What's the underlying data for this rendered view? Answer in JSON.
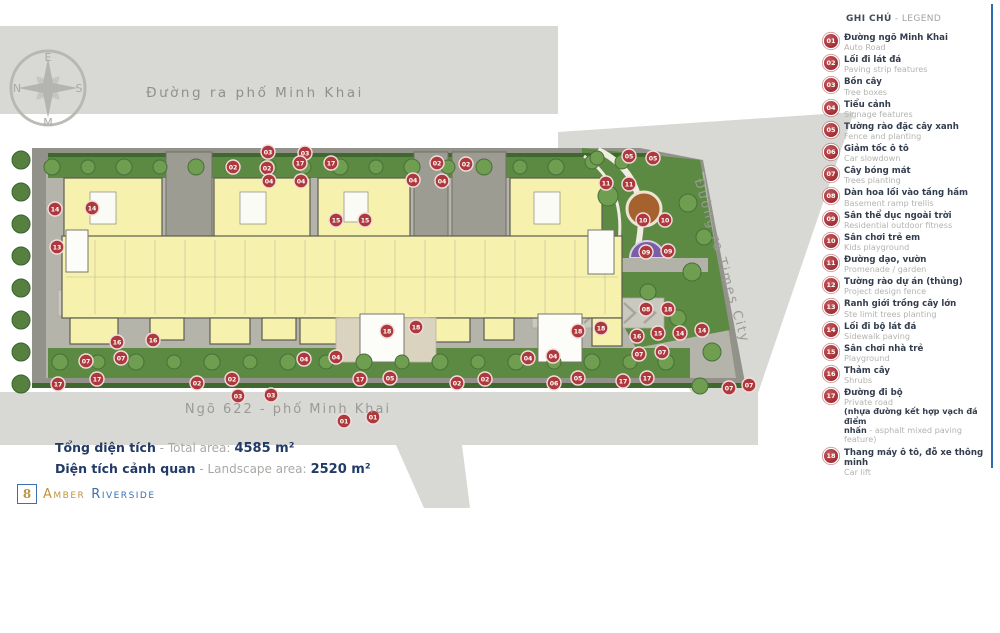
{
  "plan": {
    "road_top_label": "Đường ra phố Minh Khai",
    "road_bottom_label": "Ngõ 622 - phố Minh Khai",
    "road_right_label": "Đường ra Times City",
    "compass": {
      "top": "E",
      "left": "N",
      "right": "S",
      "bottom": "M"
    },
    "markers": [
      {
        "n": "03",
        "x": 268,
        "y": 152
      },
      {
        "n": "03",
        "x": 305,
        "y": 153
      },
      {
        "n": "17",
        "x": 300,
        "y": 163
      },
      {
        "n": "17",
        "x": 331,
        "y": 163
      },
      {
        "n": "02",
        "x": 233,
        "y": 167
      },
      {
        "n": "02",
        "x": 267,
        "y": 168
      },
      {
        "n": "04",
        "x": 269,
        "y": 181
      },
      {
        "n": "04",
        "x": 301,
        "y": 181
      },
      {
        "n": "02",
        "x": 437,
        "y": 163
      },
      {
        "n": "02",
        "x": 466,
        "y": 164
      },
      {
        "n": "04",
        "x": 413,
        "y": 180
      },
      {
        "n": "04",
        "x": 442,
        "y": 181
      },
      {
        "n": "05",
        "x": 629,
        "y": 156
      },
      {
        "n": "05",
        "x": 653,
        "y": 158
      },
      {
        "n": "11",
        "x": 606,
        "y": 183
      },
      {
        "n": "11",
        "x": 629,
        "y": 184
      },
      {
        "n": "14",
        "x": 55,
        "y": 209
      },
      {
        "n": "14",
        "x": 92,
        "y": 208
      },
      {
        "n": "13",
        "x": 57,
        "y": 247
      },
      {
        "n": "15",
        "x": 336,
        "y": 220
      },
      {
        "n": "15",
        "x": 365,
        "y": 220
      },
      {
        "n": "10",
        "x": 643,
        "y": 220
      },
      {
        "n": "10",
        "x": 665,
        "y": 220
      },
      {
        "n": "09",
        "x": 646,
        "y": 252
      },
      {
        "n": "09",
        "x": 668,
        "y": 251
      },
      {
        "n": "08",
        "x": 646,
        "y": 309
      },
      {
        "n": "18",
        "x": 668,
        "y": 309
      },
      {
        "n": "18",
        "x": 387,
        "y": 331
      },
      {
        "n": "18",
        "x": 416,
        "y": 327
      },
      {
        "n": "18",
        "x": 578,
        "y": 331
      },
      {
        "n": "18",
        "x": 601,
        "y": 328
      },
      {
        "n": "16",
        "x": 637,
        "y": 336
      },
      {
        "n": "15",
        "x": 658,
        "y": 333
      },
      {
        "n": "14",
        "x": 680,
        "y": 333
      },
      {
        "n": "14",
        "x": 702,
        "y": 330
      },
      {
        "n": "07",
        "x": 639,
        "y": 354
      },
      {
        "n": "07",
        "x": 662,
        "y": 352
      },
      {
        "n": "07",
        "x": 729,
        "y": 388
      },
      {
        "n": "07",
        "x": 749,
        "y": 385
      },
      {
        "n": "16",
        "x": 117,
        "y": 342
      },
      {
        "n": "16",
        "x": 153,
        "y": 340
      },
      {
        "n": "07",
        "x": 86,
        "y": 361
      },
      {
        "n": "07",
        "x": 121,
        "y": 358
      },
      {
        "n": "04",
        "x": 304,
        "y": 359
      },
      {
        "n": "04",
        "x": 336,
        "y": 357
      },
      {
        "n": "04",
        "x": 528,
        "y": 358
      },
      {
        "n": "04",
        "x": 553,
        "y": 356
      },
      {
        "n": "17",
        "x": 58,
        "y": 384
      },
      {
        "n": "17",
        "x": 97,
        "y": 379
      },
      {
        "n": "02",
        "x": 197,
        "y": 383
      },
      {
        "n": "02",
        "x": 232,
        "y": 379
      },
      {
        "n": "03",
        "x": 238,
        "y": 396
      },
      {
        "n": "03",
        "x": 271,
        "y": 395
      },
      {
        "n": "17",
        "x": 360,
        "y": 379
      },
      {
        "n": "05",
        "x": 390,
        "y": 378
      },
      {
        "n": "02",
        "x": 457,
        "y": 383
      },
      {
        "n": "02",
        "x": 485,
        "y": 379
      },
      {
        "n": "06",
        "x": 554,
        "y": 383
      },
      {
        "n": "05",
        "x": 578,
        "y": 378
      },
      {
        "n": "17",
        "x": 623,
        "y": 381
      },
      {
        "n": "17",
        "x": 647,
        "y": 378
      },
      {
        "n": "01",
        "x": 344,
        "y": 421
      },
      {
        "n": "01",
        "x": 373,
        "y": 417
      }
    ],
    "trees": [
      {
        "x": 52,
        "y": 167,
        "r": 8
      },
      {
        "x": 88,
        "y": 167,
        "r": 7
      },
      {
        "x": 124,
        "y": 167,
        "r": 8
      },
      {
        "x": 160,
        "y": 167,
        "r": 7
      },
      {
        "x": 196,
        "y": 167,
        "r": 8
      },
      {
        "x": 232,
        "y": 167,
        "r": 7
      },
      {
        "x": 268,
        "y": 167,
        "r": 8
      },
      {
        "x": 304,
        "y": 167,
        "r": 7
      },
      {
        "x": 340,
        "y": 167,
        "r": 8
      },
      {
        "x": 376,
        "y": 167,
        "r": 7
      },
      {
        "x": 412,
        "y": 167,
        "r": 8
      },
      {
        "x": 448,
        "y": 167,
        "r": 7
      },
      {
        "x": 484,
        "y": 167,
        "r": 8
      },
      {
        "x": 520,
        "y": 167,
        "r": 7
      },
      {
        "x": 556,
        "y": 167,
        "r": 8
      },
      {
        "x": 592,
        "y": 162,
        "r": 7
      },
      {
        "x": 60,
        "y": 362,
        "r": 8
      },
      {
        "x": 98,
        "y": 362,
        "r": 7
      },
      {
        "x": 136,
        "y": 362,
        "r": 8
      },
      {
        "x": 174,
        "y": 362,
        "r": 7
      },
      {
        "x": 212,
        "y": 362,
        "r": 8
      },
      {
        "x": 250,
        "y": 362,
        "r": 7
      },
      {
        "x": 288,
        "y": 362,
        "r": 8
      },
      {
        "x": 326,
        "y": 362,
        "r": 7
      },
      {
        "x": 364,
        "y": 362,
        "r": 8
      },
      {
        "x": 402,
        "y": 362,
        "r": 7
      },
      {
        "x": 440,
        "y": 362,
        "r": 8
      },
      {
        "x": 478,
        "y": 362,
        "r": 7
      },
      {
        "x": 516,
        "y": 362,
        "r": 8
      },
      {
        "x": 554,
        "y": 362,
        "r": 7
      },
      {
        "x": 592,
        "y": 362,
        "r": 8
      },
      {
        "x": 630,
        "y": 362,
        "r": 7
      },
      {
        "x": 666,
        "y": 362,
        "r": 8
      },
      {
        "x": 21,
        "y": 160,
        "r": 9,
        "v": "d"
      },
      {
        "x": 21,
        "y": 192,
        "r": 9,
        "v": "d"
      },
      {
        "x": 21,
        "y": 224,
        "r": 9,
        "v": "d"
      },
      {
        "x": 21,
        "y": 256,
        "r": 9,
        "v": "d"
      },
      {
        "x": 21,
        "y": 288,
        "r": 9,
        "v": "d"
      },
      {
        "x": 21,
        "y": 320,
        "r": 9,
        "v": "d"
      },
      {
        "x": 21,
        "y": 352,
        "r": 9,
        "v": "d"
      },
      {
        "x": 21,
        "y": 384,
        "r": 9,
        "v": "d"
      },
      {
        "x": 608,
        "y": 196,
        "r": 10
      },
      {
        "x": 688,
        "y": 203,
        "r": 9
      },
      {
        "x": 704,
        "y": 237,
        "r": 8
      },
      {
        "x": 692,
        "y": 272,
        "r": 9
      },
      {
        "x": 648,
        "y": 292,
        "r": 8
      },
      {
        "x": 678,
        "y": 318,
        "r": 8
      },
      {
        "x": 712,
        "y": 352,
        "r": 9
      },
      {
        "x": 700,
        "y": 386,
        "r": 8
      },
      {
        "x": 622,
        "y": 162,
        "r": 7
      },
      {
        "x": 597,
        "y": 158,
        "r": 7
      }
    ]
  },
  "legend": {
    "title_vi": "GHI CHÚ",
    "title_en": "- LEGEND",
    "items": [
      {
        "num": "01",
        "vi": "Đường ngõ Minh Khai",
        "en": "Auto Road"
      },
      {
        "num": "02",
        "vi": "Lối đi lát đá",
        "en": "Paving strip features"
      },
      {
        "num": "03",
        "vi": "Bồn cây",
        "en": "Tree boxes"
      },
      {
        "num": "04",
        "vi": "Tiểu cảnh",
        "en": "Signage features"
      },
      {
        "num": "05",
        "vi": "Tường rào đặc cây xanh",
        "en": "Fence and planting"
      },
      {
        "num": "06",
        "vi": "Giảm tốc ô tô",
        "en": "Car slowdown"
      },
      {
        "num": "07",
        "vi": "Cây bóng mát",
        "en": "Trees planting"
      },
      {
        "num": "08",
        "vi": "Dàn hoa lối vào tầng hầm",
        "en": "Basement ramp trellis"
      },
      {
        "num": "09",
        "vi": "Sân thể dục ngoài trời",
        "en": "Residential outdoor fitness"
      },
      {
        "num": "10",
        "vi": "Sân chơi trẻ em",
        "en": "Kids playground"
      },
      {
        "num": "11",
        "vi": "Đường dạo, vườn",
        "en": "Promenade /  garden"
      },
      {
        "num": "12",
        "vi": "Tường rào dự án (thủng)",
        "en": "Project design fence"
      },
      {
        "num": "13",
        "vi": "Ranh giới trồng cây lớn",
        "en": "Ste limit trees planting"
      },
      {
        "num": "14",
        "vi": "Lối đi bộ lát đá",
        "en": "Sidewalk paving"
      },
      {
        "num": "15",
        "vi": "Sân chơi nhà trẻ",
        "en": "Playground"
      },
      {
        "num": "16",
        "vi": "Thảm cây",
        "en": "Shrubs"
      },
      {
        "num": "17",
        "vi": "Đường đi bộ",
        "en": "Private road",
        "note1": "(nhựa đường kết hợp vạch đá điểm",
        "note2_vi": "nhấn",
        "note2_en": " - asphalt mixed paving feature)"
      },
      {
        "num": "18",
        "vi": "Thang máy ô tô, đỗ xe thông minh",
        "en": "Car lift"
      }
    ]
  },
  "summary": {
    "sep": " - ",
    "total": {
      "vi": "Tổng diện tích",
      "en": "Total area:",
      "value": "4585 m²"
    },
    "landscape": {
      "vi": "Diện tích cảnh quan",
      "en": "Landscape area:",
      "value": "2520 m²"
    }
  },
  "logo": {
    "symbol": "8",
    "name_gold": "Amber",
    "name_blue": "Riverside"
  },
  "colors": {
    "road": "#d8d8d4",
    "paving": "#92928a",
    "green": "#5c8a42",
    "building_yellow": "#f6f1ac",
    "marker_red": "#ad393d",
    "playground_brown": "#a5612e",
    "fitness_purple": "#7a5fa8",
    "rule_blue": "#2e6bb0",
    "logo_gold": "#bf9440",
    "logo_blue": "#3c70ae",
    "summary_navy": "#223a66"
  }
}
